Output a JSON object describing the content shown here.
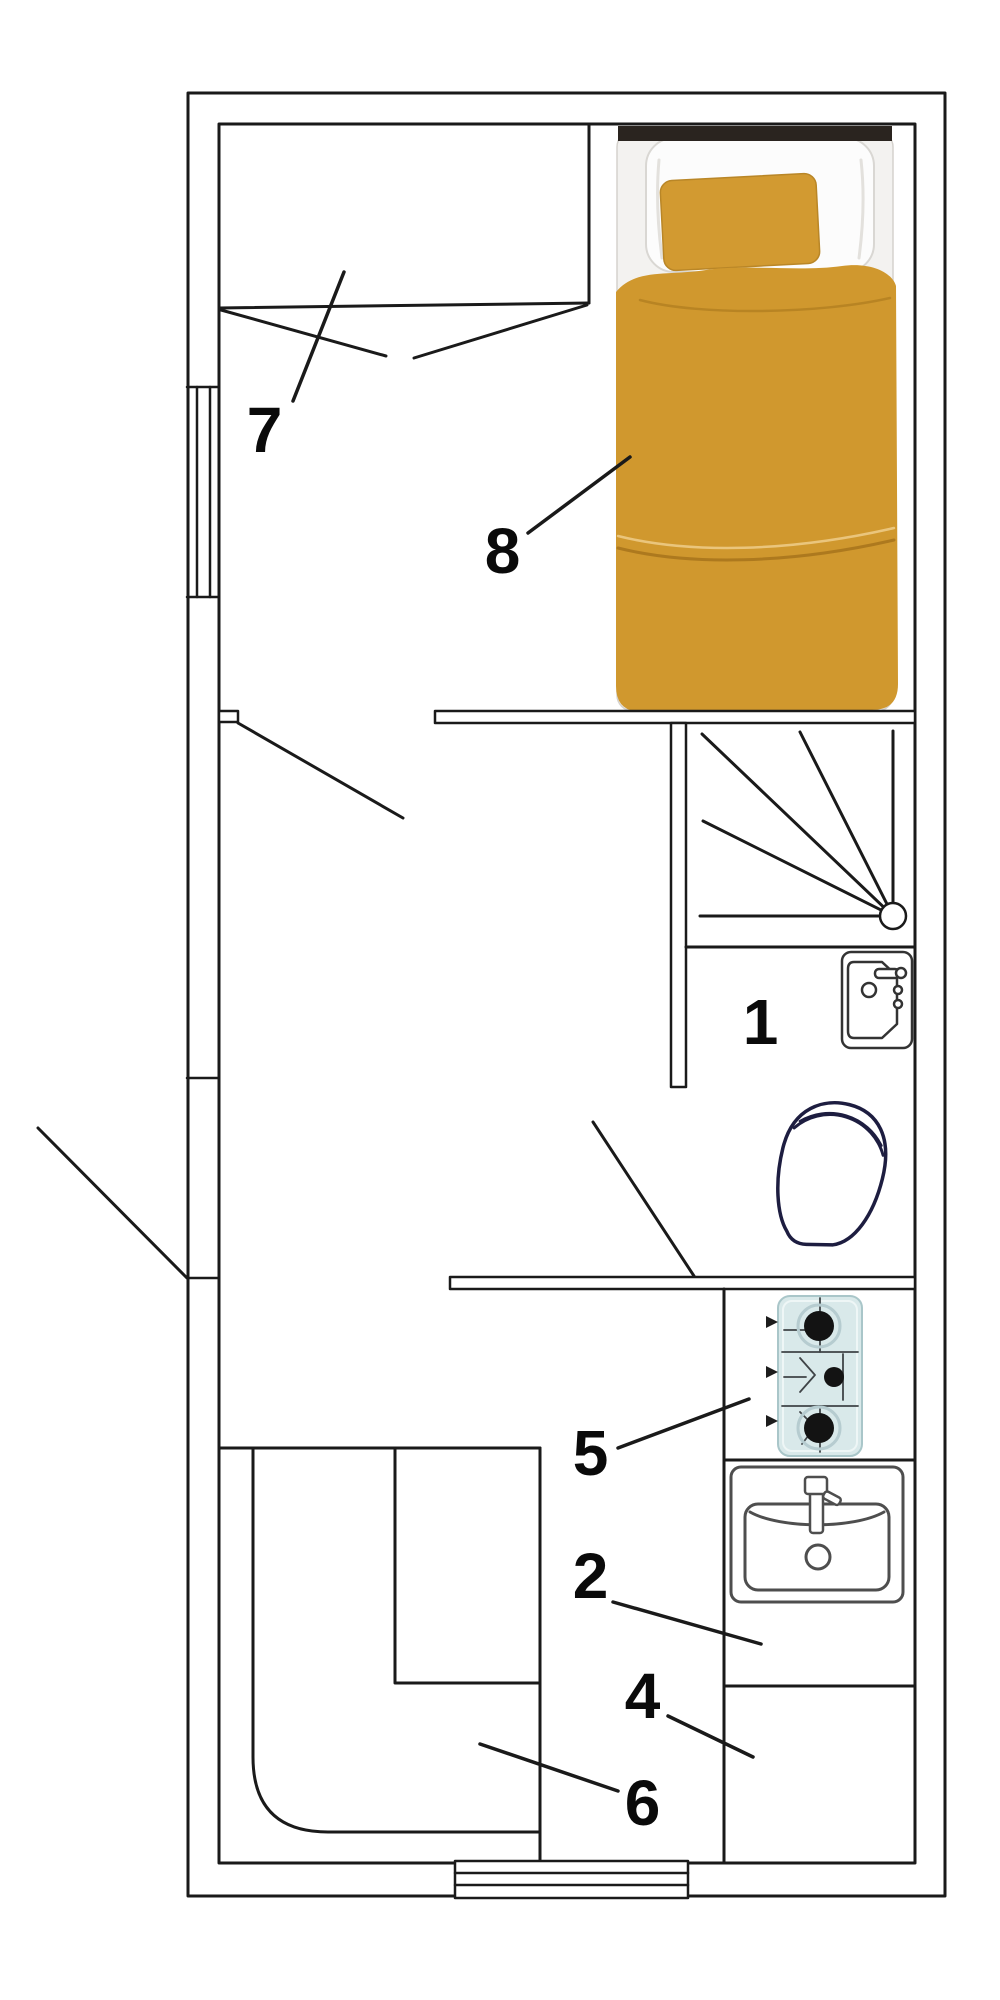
{
  "plan": {
    "figure_type": "architectural-floor-plan",
    "labels": [
      {
        "text": "1",
        "room": "washbasin-area"
      },
      {
        "text": "2",
        "room": "kitchen-sink-counter"
      },
      {
        "text": "4",
        "room": "kitchen-counter"
      },
      {
        "text": "5",
        "room": "gas-hob"
      },
      {
        "text": "6",
        "room": "corner-bench"
      },
      {
        "text": "7",
        "room": "wardrobe"
      },
      {
        "text": "8",
        "room": "single-bed"
      }
    ],
    "fixtures": [
      {
        "name": "single-bed",
        "label_ref": "8"
      },
      {
        "name": "wardrobe-rail",
        "label_ref": "7"
      },
      {
        "name": "winder-staircase"
      },
      {
        "name": "washbasin",
        "label_ref": "1"
      },
      {
        "name": "toilet"
      },
      {
        "name": "gas-hob",
        "label_ref": "5"
      },
      {
        "name": "kitchen-sink",
        "label_ref": "2"
      },
      {
        "name": "counter-area",
        "label_ref": "4"
      },
      {
        "name": "corner-bench-with-table",
        "label_ref": "6"
      },
      {
        "name": "entry-door-left-wall"
      },
      {
        "name": "interior-door-hall"
      },
      {
        "name": "interior-door-bathroom"
      },
      {
        "name": "sliding-door-bottom-wall"
      },
      {
        "name": "window-left-wall"
      }
    ],
    "colors": {
      "wall_line": "#1a1a1a",
      "bed_duvet": "#d0982e",
      "bed_pillow": "#d29a31",
      "headboard": "#2a241f",
      "mattress": "#f3f2f0",
      "stove_body": "#d9e9ea",
      "burner": "#131313",
      "toilet_outline": "#1d1d40",
      "sink_outline": "#4e4e4e",
      "label_text": "#0a0a0a",
      "paper": "#ffffff"
    }
  }
}
